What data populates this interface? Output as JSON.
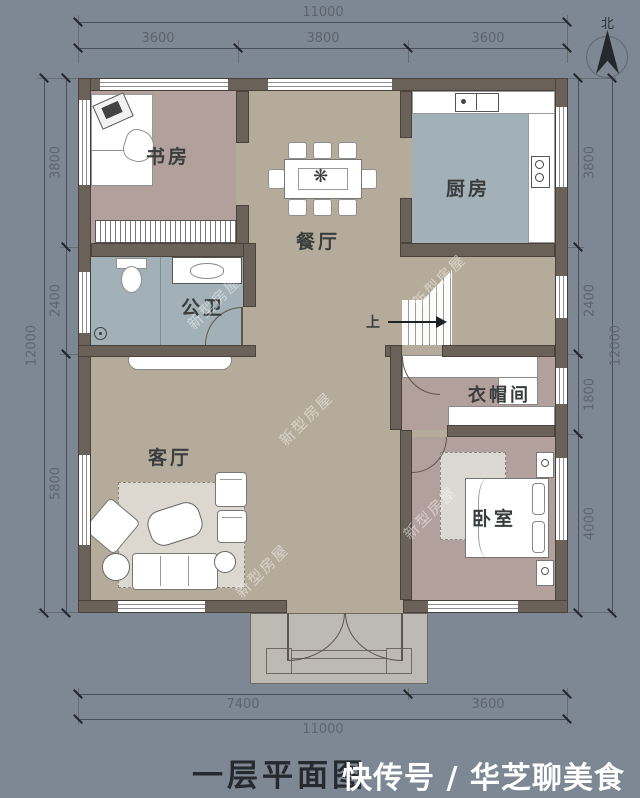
{
  "plan": {
    "title": "一层平面图",
    "brand_watermark": "快传号 / 华芝聊美食",
    "diagonal_watermark": "新型房屋",
    "north_label": "北"
  },
  "dimensions": {
    "top_total": "11000",
    "top_segments": [
      "3600",
      "3800",
      "3600"
    ],
    "left_total": "12000",
    "left_segments": [
      "3800",
      "2400",
      "5800"
    ],
    "right_total": "12000",
    "right_segments": [
      "3800",
      "2400",
      "1800",
      "4000"
    ],
    "bottom_total": "11000",
    "bottom_segments": [
      "7400",
      "3600"
    ]
  },
  "rooms": {
    "study": "书房",
    "dining": "餐厅",
    "kitchen": "厨房",
    "bathroom": "公卫",
    "stairs_up": "上",
    "cloakroom": "衣帽间",
    "living": "客厅",
    "bedroom": "卧室"
  },
  "colors": {
    "background": "#7d8894",
    "wall": "#6a6258",
    "floor_warm": "#b5ab9a",
    "floor_mauve": "#b2a09c",
    "floor_cool": "#a2b1b8",
    "porch": "#bcbab3"
  }
}
